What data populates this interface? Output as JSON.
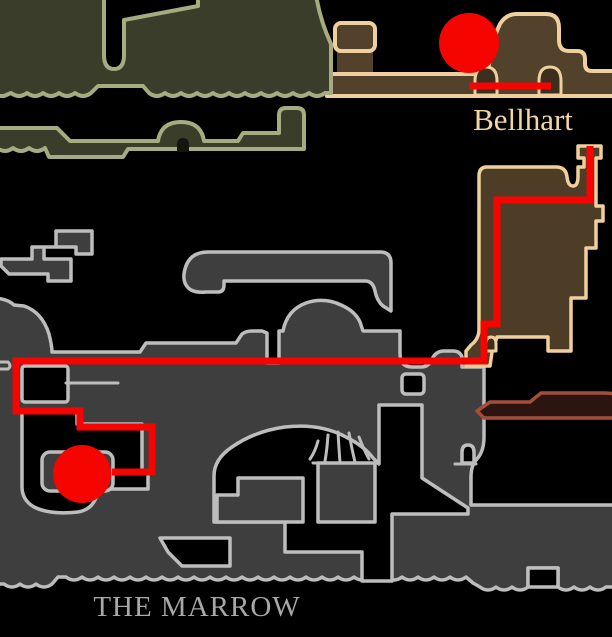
{
  "labels": {
    "bellhart": "Bellhart",
    "the_marrow": "THE MARROW"
  },
  "colors": {
    "bg": "#000000",
    "olive-fill": "#3b3d2b",
    "olive-outline": "#a6ab80",
    "tan-fill": "#53422b",
    "tan-room-fill": "#4d3d27",
    "tan-arch-fill": "#3c2f1d",
    "tan-outline": "#f0cf9e",
    "maroon-fill": "#2c1410",
    "maroon-outline": "#a24f3a",
    "gray-fill": "#3e3e3e",
    "gray-outline": "#bdbdbd",
    "route-red": "#f60400",
    "label-tan": "#f5d7a4",
    "label-gray": "#a8a8a8"
  },
  "route": {
    "segments": [
      {
        "name": "bellhart-town-segment",
        "points": "469,86 551,86"
      },
      {
        "name": "main-route-segment",
        "points": "590,146 590,200 497,200 497,324 484,324 484,361 16,361 16,411 80,411 80,427 152,427 152,472 112,472"
      }
    ],
    "markers": [
      {
        "name": "bellhart-marker",
        "cx": 469,
        "cy": 43,
        "r": 30
      },
      {
        "name": "marrow-marker",
        "cx": 82,
        "cy": 474,
        "r": 29
      }
    ]
  }
}
